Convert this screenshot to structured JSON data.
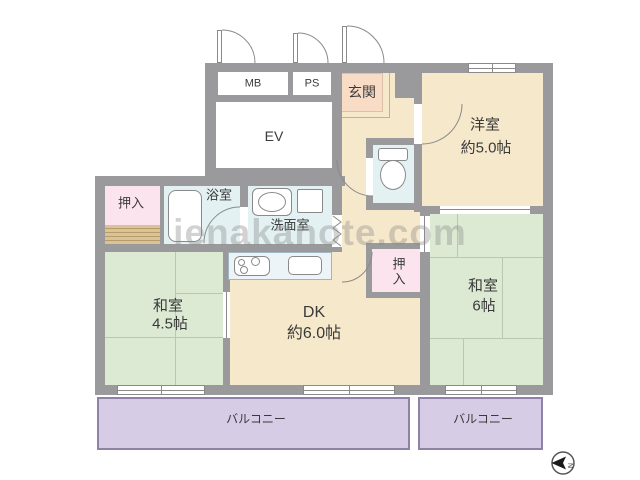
{
  "watermark": "ienakanote.com",
  "labels": {
    "mb": "MB",
    "ps": "PS",
    "genkan": "玄関",
    "ev": "EV",
    "yoshitsu": {
      "name": "洋室",
      "size": "約5.0帖"
    },
    "oshiire_left": "押入",
    "bathroom": "浴室",
    "washroom": "洗面室",
    "washitsu45": {
      "name": "和室",
      "size": "4.5帖"
    },
    "dk": {
      "name": "DK",
      "size": "約6.0帖"
    },
    "oshiire_right": "押入",
    "washitsu6": {
      "name": "和室",
      "size": "6帖"
    },
    "balcony_left": "バルコニー",
    "balcony_right": "バルコニー",
    "compass_n": "N"
  },
  "colors": {
    "wall": "#9a9a9c",
    "beige": "#f6e8cb",
    "genkan": "#f9dcc6",
    "tatami": "#dcead3",
    "tatamiLine": "#b7c9ae",
    "pink": "#fce4ef",
    "wet": "#e3f1f3",
    "counter": "#edf4f8",
    "balcony": "#d7cce6",
    "balconyBorder": "#8e82a8",
    "stripeBase": "#d9c499",
    "stripeLine": "#b89b66",
    "outline": "#8a8a8a",
    "label": "#3a3a3a",
    "watermark": "#8c8c8c"
  }
}
